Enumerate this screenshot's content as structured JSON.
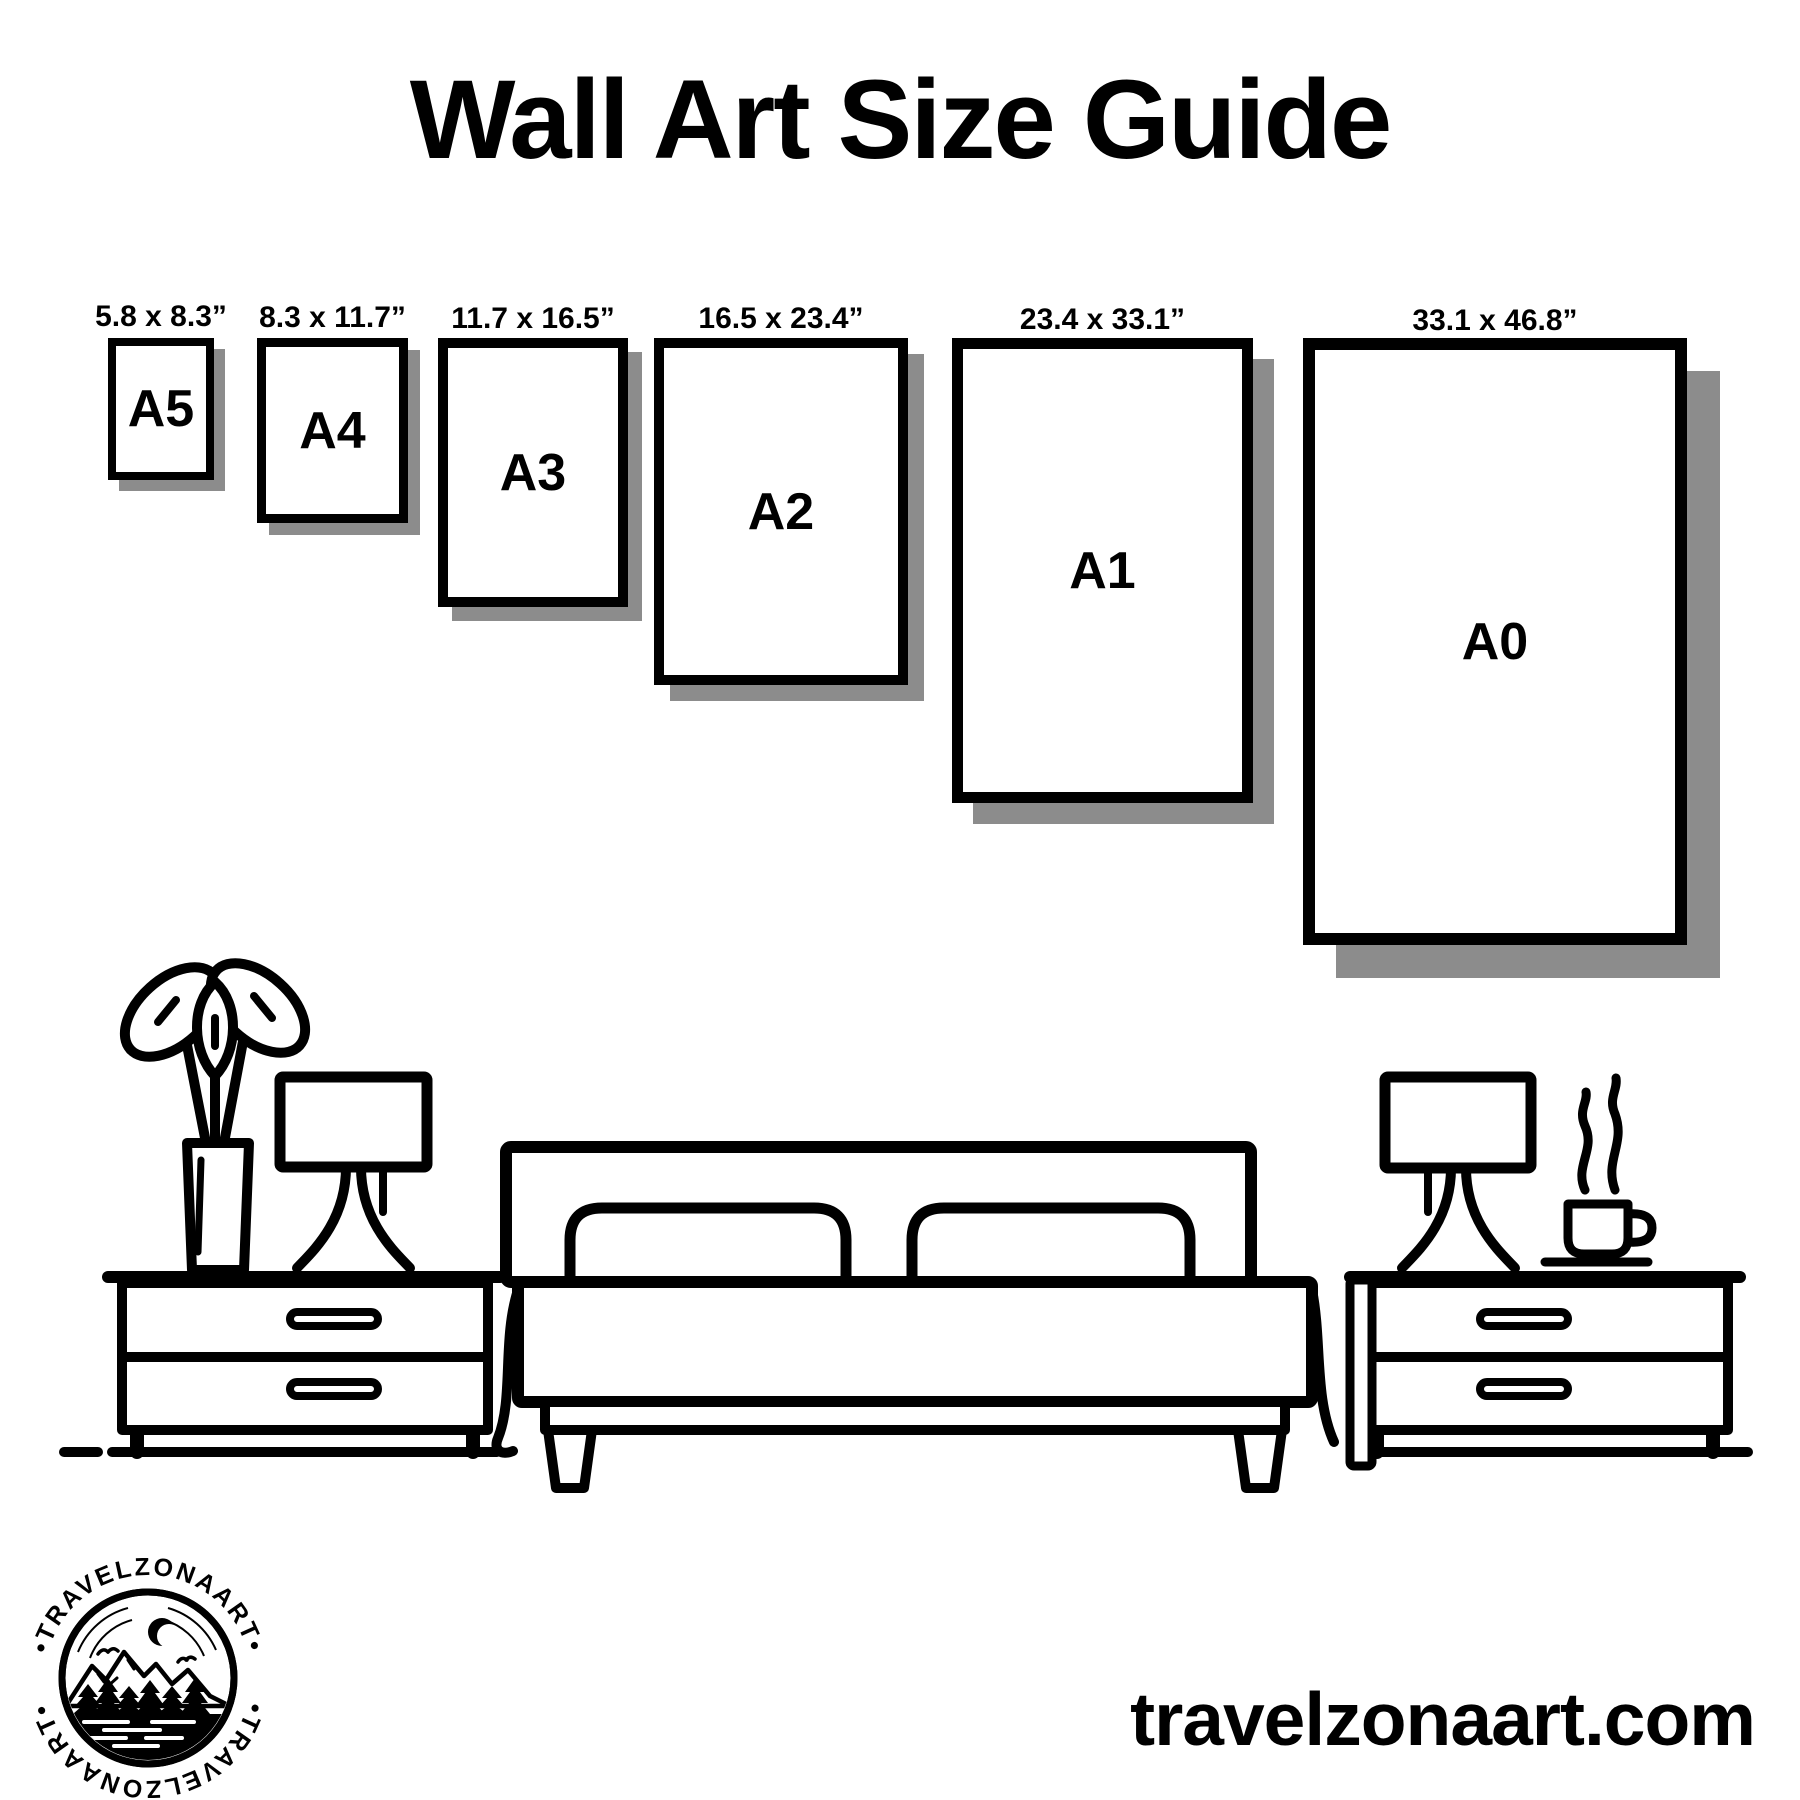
{
  "title": "Wall Art Size Guide",
  "frames": [
    {
      "name": "A5",
      "size": "5.8 x 8.3”"
    },
    {
      "name": "A4",
      "size": "8.3 x 11.7”"
    },
    {
      "name": "A3",
      "size": "11.7 x 16.5”"
    },
    {
      "name": "A2",
      "size": "16.5 x 23.4”"
    },
    {
      "name": "A1",
      "size": "23.4 x 33.1”"
    },
    {
      "name": "A0",
      "size": "33.1 x 46.8”"
    }
  ],
  "logo": {
    "arc_top": "•TRAVELZONAART•",
    "arc_bottom": "•TRAVELZONAART•",
    "icon": "mountain-forest-moon-badge"
  },
  "website": "travelzonaart.com",
  "scene_icons": [
    "plant-vase",
    "table-lamp-left",
    "nightstand-left",
    "bed-with-pillows",
    "table-lamp-right",
    "coffee-cup-steam",
    "nightstand-right",
    "floor-line"
  ],
  "colors": {
    "ink": "#000000",
    "paper": "#ffffff",
    "shadow": "#8c8c8c"
  }
}
